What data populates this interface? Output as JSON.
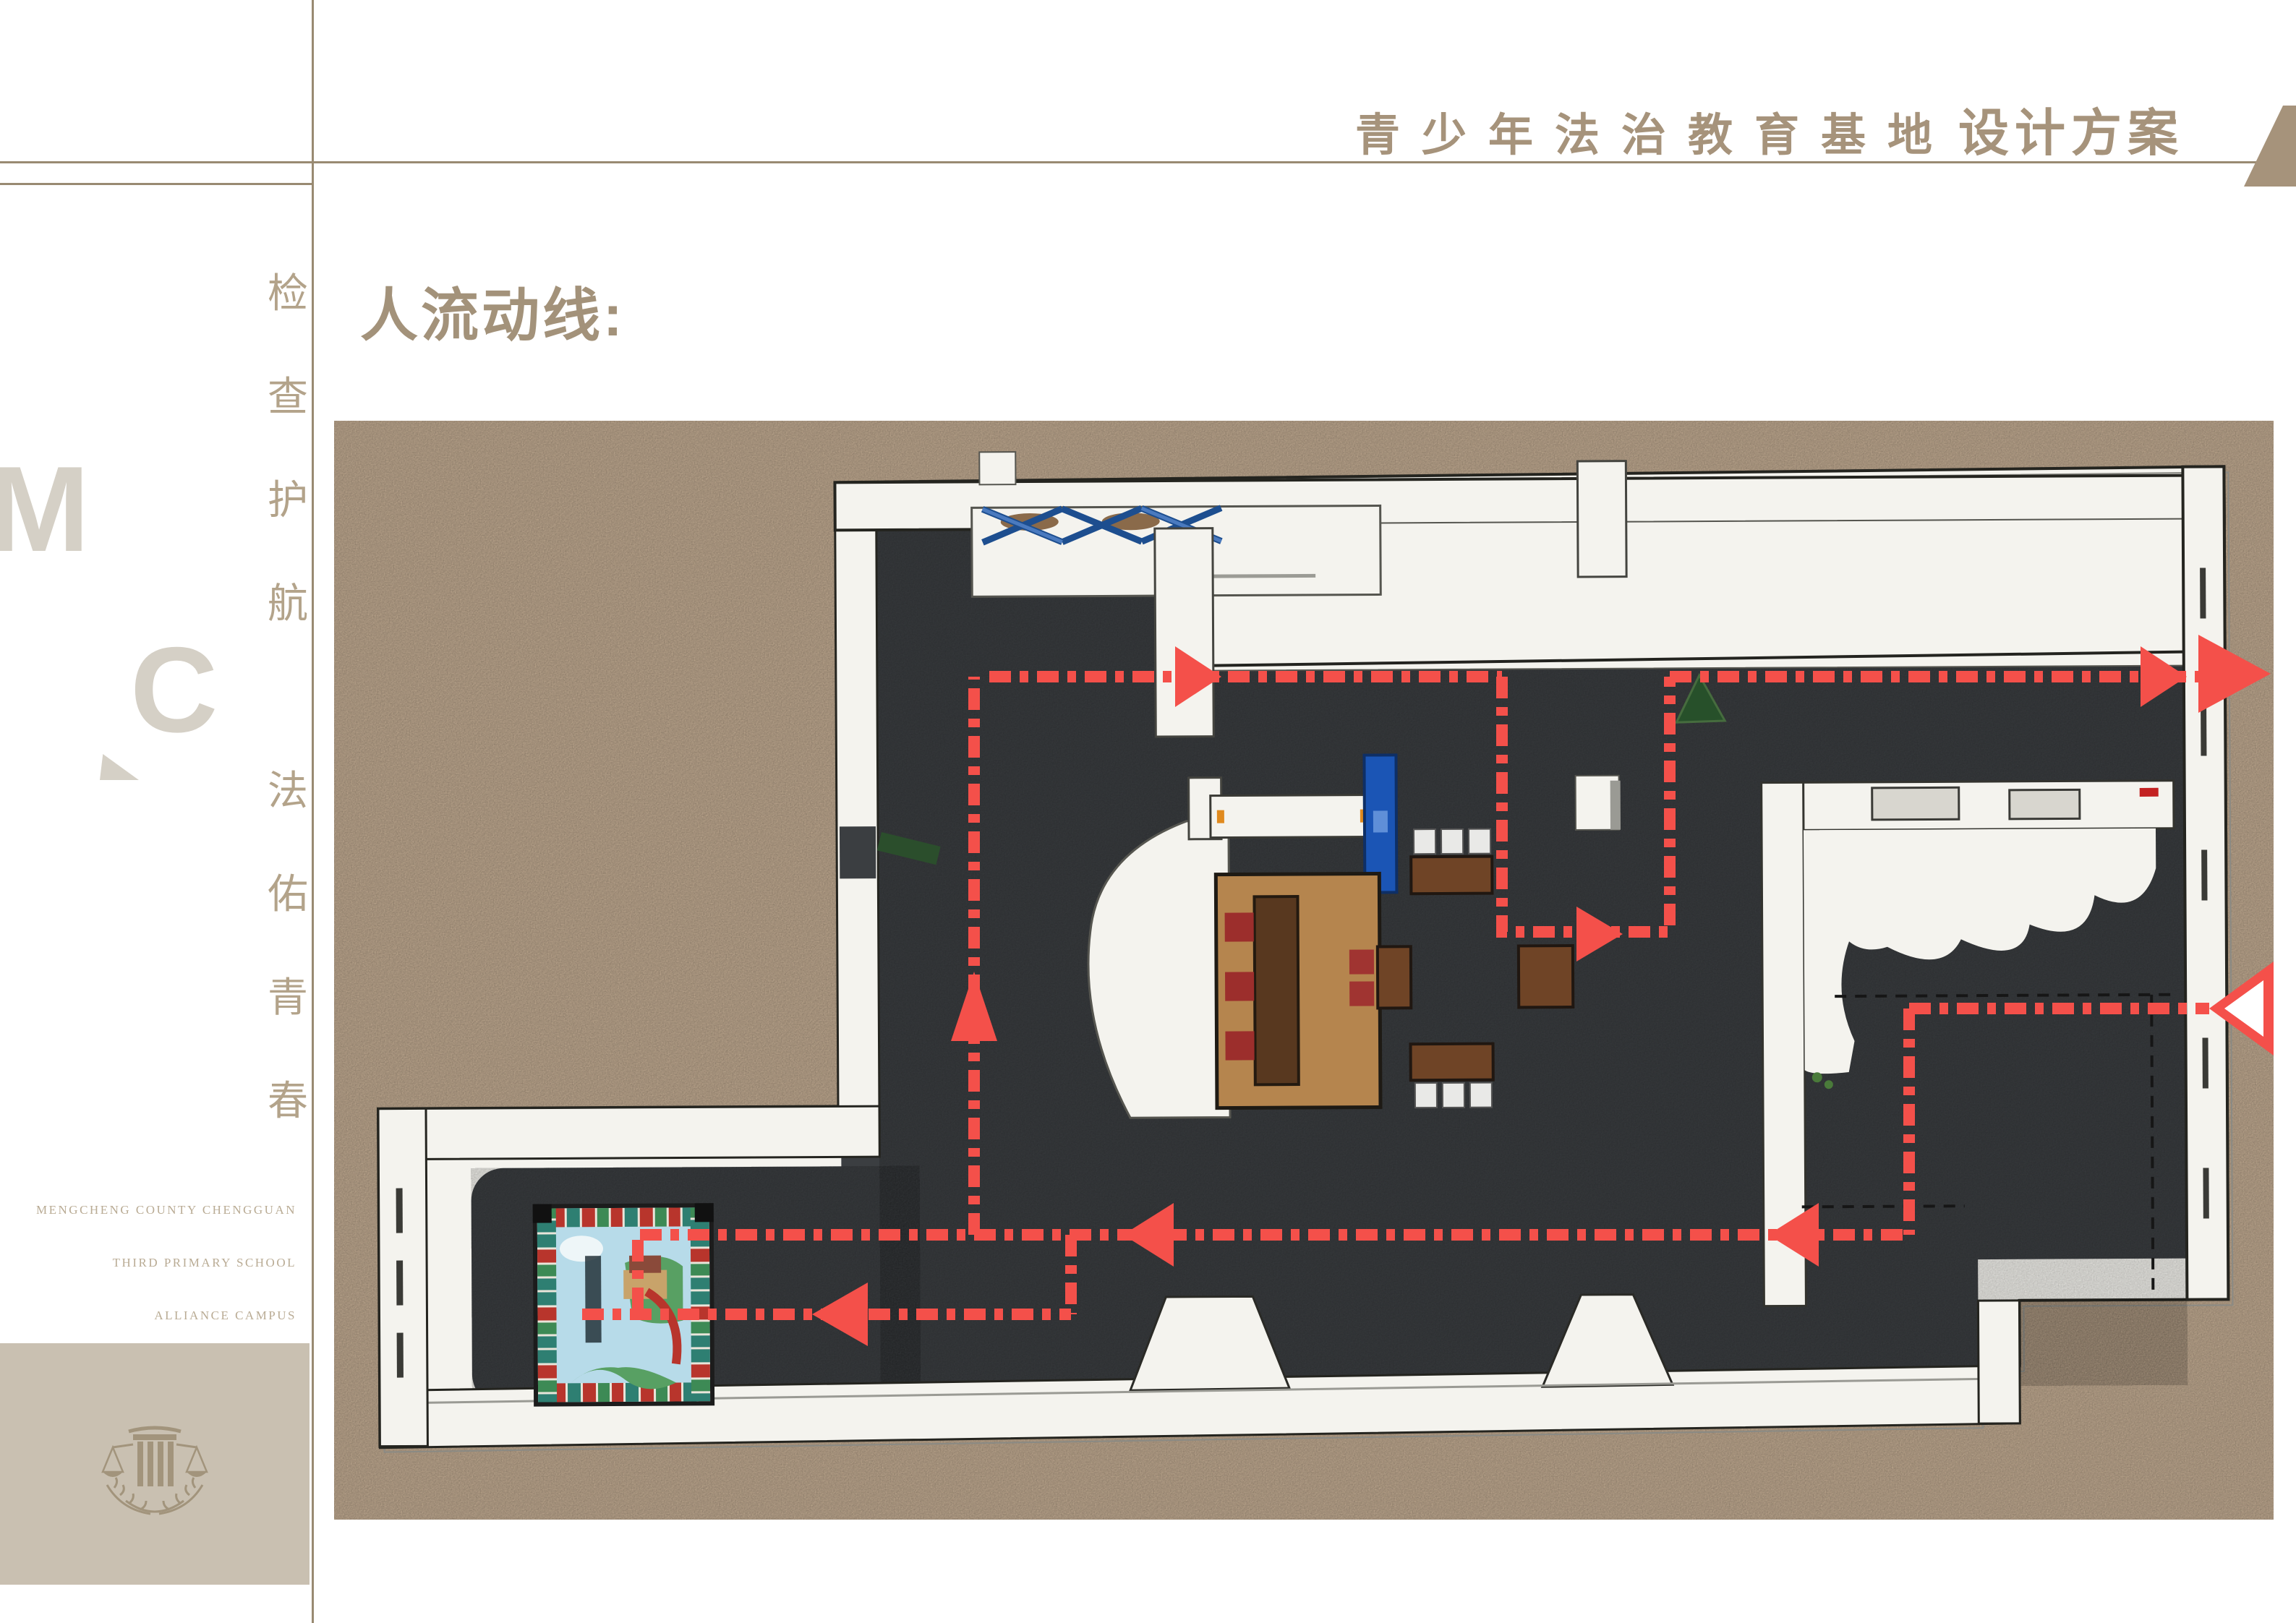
{
  "header": {
    "title_serif": "青少年法治教育基地",
    "title_bold": "设计方案"
  },
  "sidebar": {
    "letter_m": "M",
    "letter_c": "C",
    "slogan_top": [
      "检",
      "查",
      "护",
      "航"
    ],
    "slogan_bottom": [
      "法",
      "佑",
      "青",
      "春"
    ],
    "english_lines": [
      "MENGCHENG COUNTY CHENGGUAN",
      "THIRD PRIMARY SCHOOL",
      "ALLIANCE CAMPUS"
    ],
    "logo_icon": "scales-of-justice-icon"
  },
  "main": {
    "section_title": "人流动线:",
    "plan": {
      "type_icon": "floor-plan",
      "entrance_icon": "entrance-arrow",
      "exit_icon": "exit-arrow",
      "route_icon": "dashed-route-line"
    }
  },
  "colors": {
    "page_bg": "#ffffff",
    "accent": "#a6937b",
    "title": "#a3927a",
    "rule": "#998a72",
    "slogan": "#b3a38a",
    "eng": "#b9ab94",
    "logo_gray": "#d5d0c6",
    "badge_bg": "#c9c0b1",
    "badge_icon": "#a2947c",
    "plan_tan": "#cdb59a",
    "plan_floor": "#3b3e41",
    "plan_wall": "#f4f3ee",
    "route_red": "#f4504a"
  }
}
